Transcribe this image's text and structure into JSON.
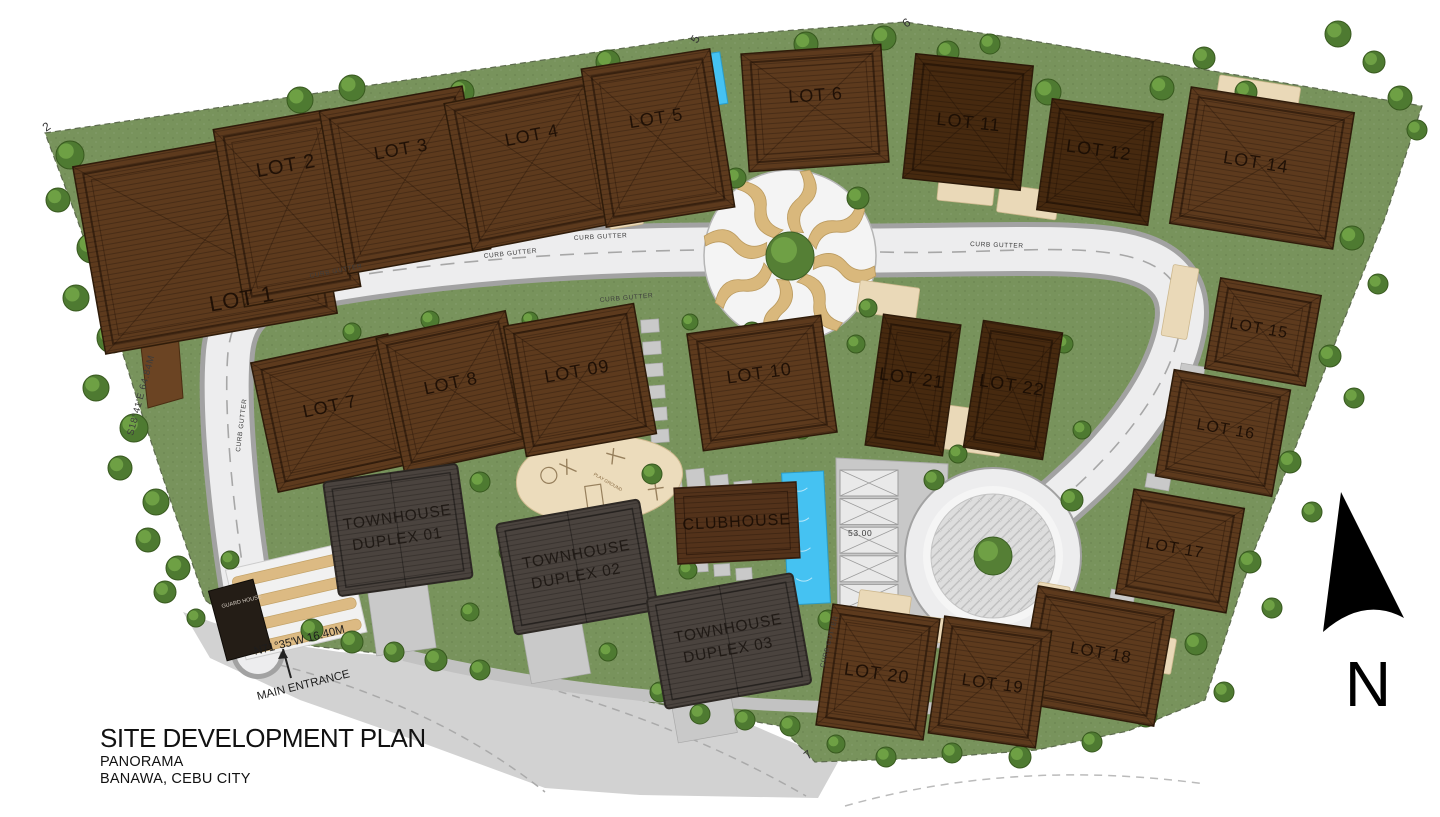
{
  "title": {
    "main": "SITE DEVELOPMENT PLAN",
    "sub1": "PANORAMA",
    "sub2": "BANAWA, CEBU CITY"
  },
  "north": {
    "label": "N"
  },
  "entrance": {
    "bearing": "N71°35'W 16.40M",
    "label": "MAIN ENTRANCE"
  },
  "annotations": {
    "curb_gutter": "CURB GUTTER",
    "cistern_tank": "CISTERN TANK",
    "guard_house": "GUARD HOUSE",
    "parking_dimension": "53.00",
    "playground": "PLAY GROUND",
    "west_boundary_bearing": "S18°41'E 64.84M",
    "corner_markers": [
      "2",
      "5",
      "6",
      "7"
    ]
  },
  "buildings": {
    "lots": [
      {
        "label": "LOT 1"
      },
      {
        "label": "LOT 2"
      },
      {
        "label": "LOT 3"
      },
      {
        "label": "LOT 4"
      },
      {
        "label": "LOT 5"
      },
      {
        "label": "LOT 6"
      },
      {
        "label": "LOT 7"
      },
      {
        "label": "LOT 8"
      },
      {
        "label": "LOT 09"
      },
      {
        "label": "LOT 10"
      },
      {
        "label": "LOT 11"
      },
      {
        "label": "LOT 12"
      },
      {
        "label": "LOT 14"
      },
      {
        "label": "LOT 15"
      },
      {
        "label": "LOT 16"
      },
      {
        "label": "LOT 17"
      },
      {
        "label": "LOT 18"
      },
      {
        "label": "LOT 19"
      },
      {
        "label": "LOT 20"
      },
      {
        "label": "LOT 21"
      },
      {
        "label": "LOT 22"
      }
    ],
    "townhouses": [
      {
        "line1": "TOWNHOUSE",
        "line2": "DUPLEX 01"
      },
      {
        "line1": "TOWNHOUSE",
        "line2": "DUPLEX 02"
      },
      {
        "line1": "TOWNHOUSE",
        "line2": "DUPLEX 03"
      }
    ],
    "clubhouse": {
      "label": "CLUBHOUSE"
    }
  }
}
